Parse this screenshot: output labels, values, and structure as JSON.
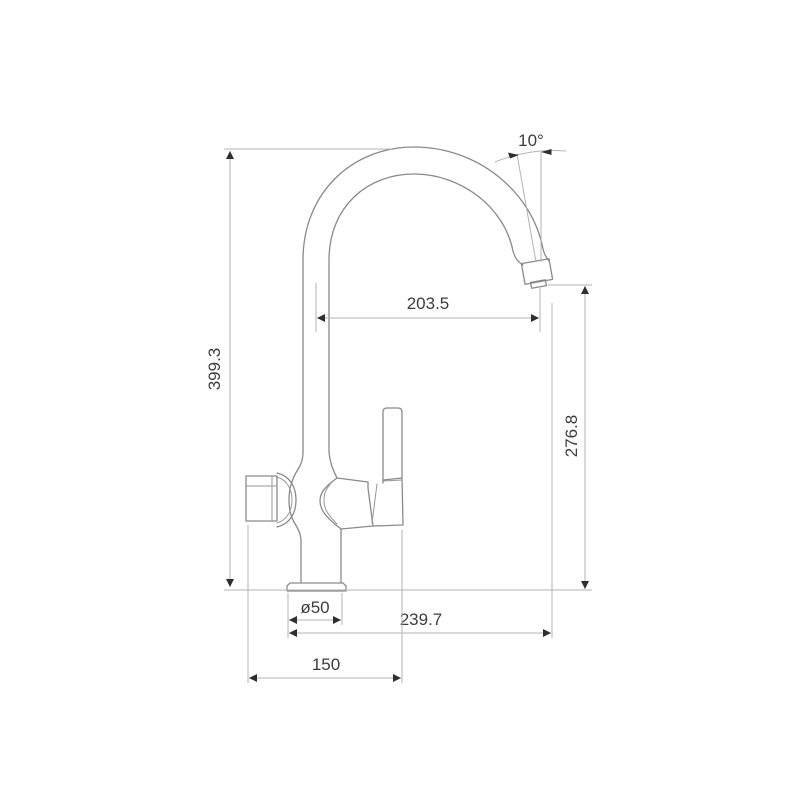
{
  "page": {
    "background": "#ffffff"
  },
  "diagram": {
    "name": "Kitchen faucet technical drawing",
    "view": "side elevation with dimensions",
    "colors": {
      "outline": "#8a8a8a",
      "dimension_line": "#b3b3b3",
      "text": "#3d3d3d",
      "arrow": "#2f2f2f"
    },
    "labels": {
      "spout_angle": "10°",
      "spout_reach": "203.5",
      "overall_height": "399.3",
      "outlet_height": "276.8",
      "base_diameter": "ø50",
      "overall_depth": "239.7",
      "body_width": "150"
    },
    "dimension_values": {
      "spout_angle_deg": 10,
      "spout_reach_mm": 203.5,
      "overall_height_mm": 399.3,
      "outlet_height_mm": 276.8,
      "base_diameter_mm": 50,
      "overall_depth_mm": 239.7,
      "body_width_mm": 150
    }
  }
}
